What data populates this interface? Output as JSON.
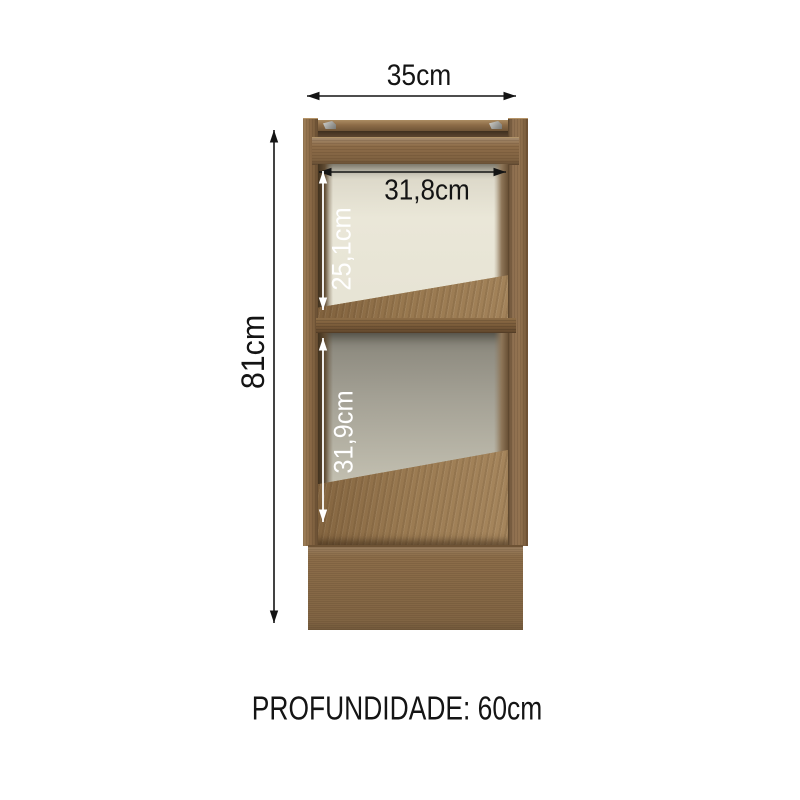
{
  "diagram": {
    "labels": {
      "width": "35cm",
      "height": "81cm",
      "inner_width": "31,8cm",
      "upper_compartment_height": "25,1cm",
      "lower_compartment_height": "31,9cm",
      "depth": "PROFUNDIDADE: 60cm"
    },
    "colors": {
      "background": "#ffffff",
      "wood_mid": "#8d6c48",
      "wood_light": "#a0815a",
      "wood_dark": "#644b30",
      "shelf_edge": "#7a5c3b",
      "back_panel_light": "#eae7d8",
      "back_panel_shadow": "#88857a",
      "plinth": "#8c6d49",
      "metal_bracket": "#d4d4d0",
      "dimension_black": "#141414",
      "dimension_white": "#ffffff"
    }
  }
}
